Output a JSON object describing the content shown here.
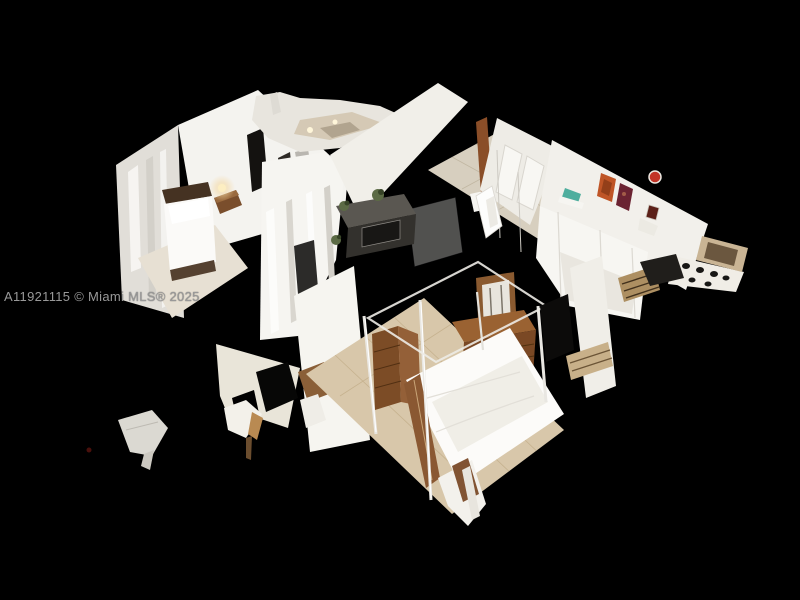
{
  "scene": {
    "background_color": "#000000",
    "description": "3D dollhouse cutaway scan of a furnished residence (bedrooms, hallway, living area) viewed from above at an angle, floating on a black background with detached scan fragments"
  },
  "watermark": {
    "text": "A11921115 © Miami MLS® 2025",
    "color": "#999999"
  },
  "palette": {
    "wall_white": "#f5f4f0",
    "wall_shadow": "#e1ded8",
    "carpet": "#e7e0d3",
    "wood_floor": "#d8c7aa",
    "tile_floor": "#d7cfbf",
    "furniture_wood": "#7a4824",
    "media_console_dark": "#33312d",
    "bedding_white": "#fcfbf9",
    "art_orange": "#bf5526",
    "art_red_circle": "#c23326",
    "teal_accent": "#4fae9e",
    "lamp_glow": "#f3d9a6"
  }
}
